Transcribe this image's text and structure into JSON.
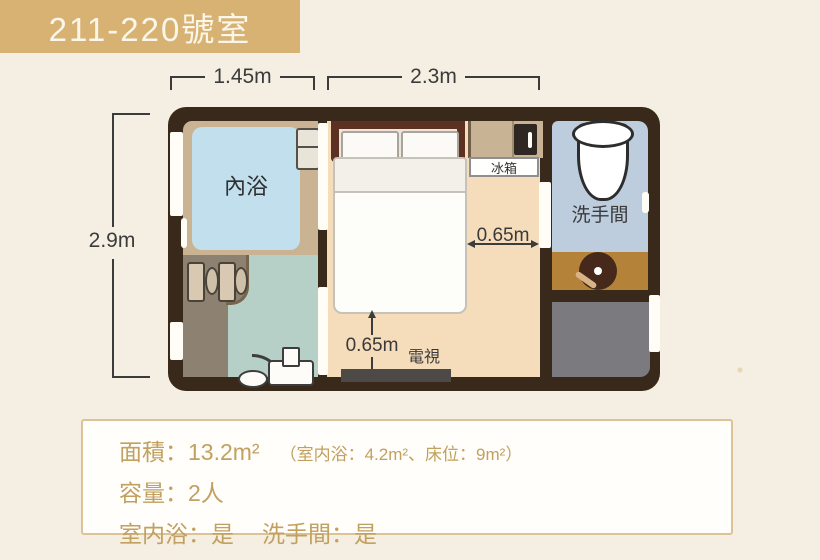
{
  "header": {
    "title": "211-220號室"
  },
  "plan": {
    "rooms": {
      "bath": "內浴",
      "washroom": "洗手間",
      "fridge": "冰箱",
      "tv": "電視"
    },
    "dimensions": {
      "top_left": "1.45m",
      "top_middle": "2.3m",
      "left": "2.9m",
      "right_gap": "0.65m",
      "bottom_gap": "0.65m"
    }
  },
  "info": {
    "area": "面積：13.2m²",
    "area_detail": "（室内浴：4.2m²、床位：9m²）",
    "capacity": "容量：2人",
    "indoor_bath": "室内浴：是",
    "washroom": "洗手間：是"
  },
  "colors": {
    "header_bg": "#d8b273",
    "background": "#f4efe2",
    "wall": "#38291b",
    "bath_blue": "#c2dfee",
    "washroom_blue": "#becdde",
    "bedroom_floor": "#f5dcba",
    "sink_area_brown": "#b5823a",
    "info_text_gold": "#c2a05f"
  }
}
